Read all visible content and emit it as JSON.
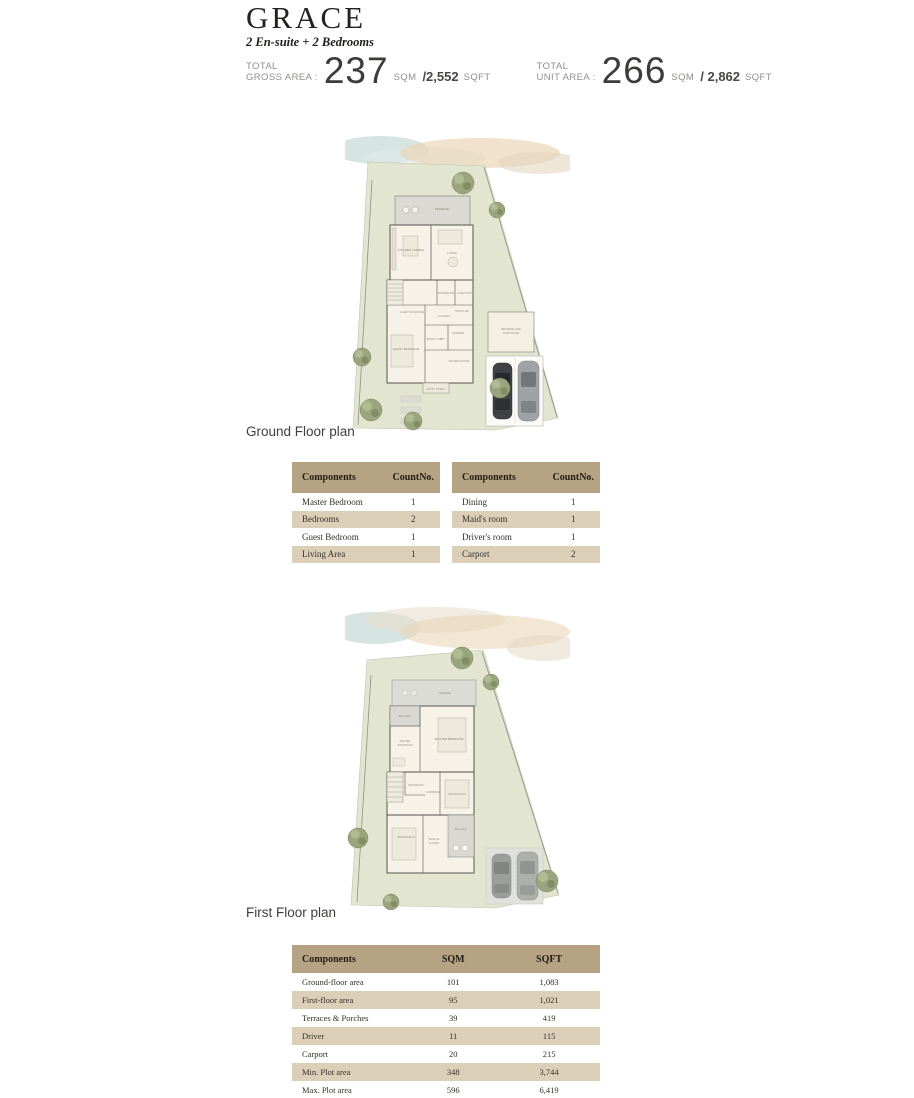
{
  "header": {
    "title": "GRACE",
    "subtitle": "2 En-suite + 2 Bedrooms"
  },
  "stats": {
    "gross": {
      "label_line1": "TOTAL",
      "label_line2": "GROSS AREA :",
      "value": "237",
      "unit1": "SQM",
      "value2": "/2,552",
      "unit2": "SQFT"
    },
    "unit": {
      "label_line1": "TOTAL",
      "label_line2": "UNIT AREA :",
      "value": "266",
      "unit1": "SQM",
      "value2": "/ 2,862",
      "unit2": "SQFT"
    }
  },
  "plans": {
    "ground": {
      "caption": "Ground Floor plan",
      "labels": {
        "terrace": "TERRACE",
        "kitchen": "KITCHEN / DINING",
        "living": "LIVING",
        "powder": "POWDER RM",
        "guest_bath": "GUEST BATH",
        "guest_bathroom": "GUEST BATHROOM",
        "guest_bedroom": "GUEST BEDROOM",
        "laundry": "LAUNDRY",
        "maid": "MAID'S RM",
        "shower": "SHOWER",
        "lobby": "ENTRY LOBBY",
        "driver": "DRIVER'S ROOM",
        "porch": "ENTRY PORCH",
        "pump_1": "METERING AND",
        "pump_2": "PUMP ROOM"
      }
    },
    "first": {
      "caption": "First Floor plan",
      "labels": {
        "terrace": "TERRACE",
        "balcony_top": "BALCONY",
        "master_bathroom_1": "MASTER",
        "master_bathroom_2": "BATHROOM",
        "master_bedroom": "MASTER BEDROOM",
        "bathroom": "BATHROOM",
        "corridor": "CORRIDOR",
        "bedroom_02": "BEDROOM 02",
        "bedroom_03": "BEDROOM 03",
        "closet_1": "WALK-IN",
        "closet_2": "CLOSET",
        "balcony_bottom": "BALCONY"
      }
    }
  },
  "tables": {
    "components_left": {
      "headers": [
        "Components",
        "CountNo."
      ],
      "rows": [
        [
          "Master Bedroom",
          "1"
        ],
        [
          "Bedrooms",
          "2"
        ],
        [
          "Guest Bedroom",
          "1"
        ],
        [
          "Living Area",
          "1"
        ]
      ]
    },
    "components_right": {
      "headers": [
        "Components",
        "CountNo."
      ],
      "rows": [
        [
          "Dining",
          "1"
        ],
        [
          "Maid's room",
          "1"
        ],
        [
          "Driver's room",
          "1"
        ],
        [
          "Carport",
          "2"
        ]
      ]
    },
    "areas": {
      "headers": [
        "Components",
        "SQM",
        "SQFT"
      ],
      "rows": [
        [
          "Ground-floor area",
          "101",
          "1,083"
        ],
        [
          "First-floor area",
          "95",
          "1,021"
        ],
        [
          "Terraces & Porches",
          "39",
          "419"
        ],
        [
          "Driver",
          "11",
          "115"
        ],
        [
          "Carport",
          "20",
          "215"
        ],
        [
          "Min. Plot area",
          "348",
          "3,744"
        ],
        [
          "Max. Plot area",
          "596",
          "6,419"
        ]
      ]
    }
  },
  "colors": {
    "table_header": "#b5a384",
    "table_row_alt": "#dbcfb8",
    "plot_green": "#e2e6d1",
    "terrace_grey": "#dad9d3",
    "house_cream": "#f7f2e8",
    "sand_wash": "#e9d6b8",
    "sea_wash": "#cfe0dc"
  }
}
